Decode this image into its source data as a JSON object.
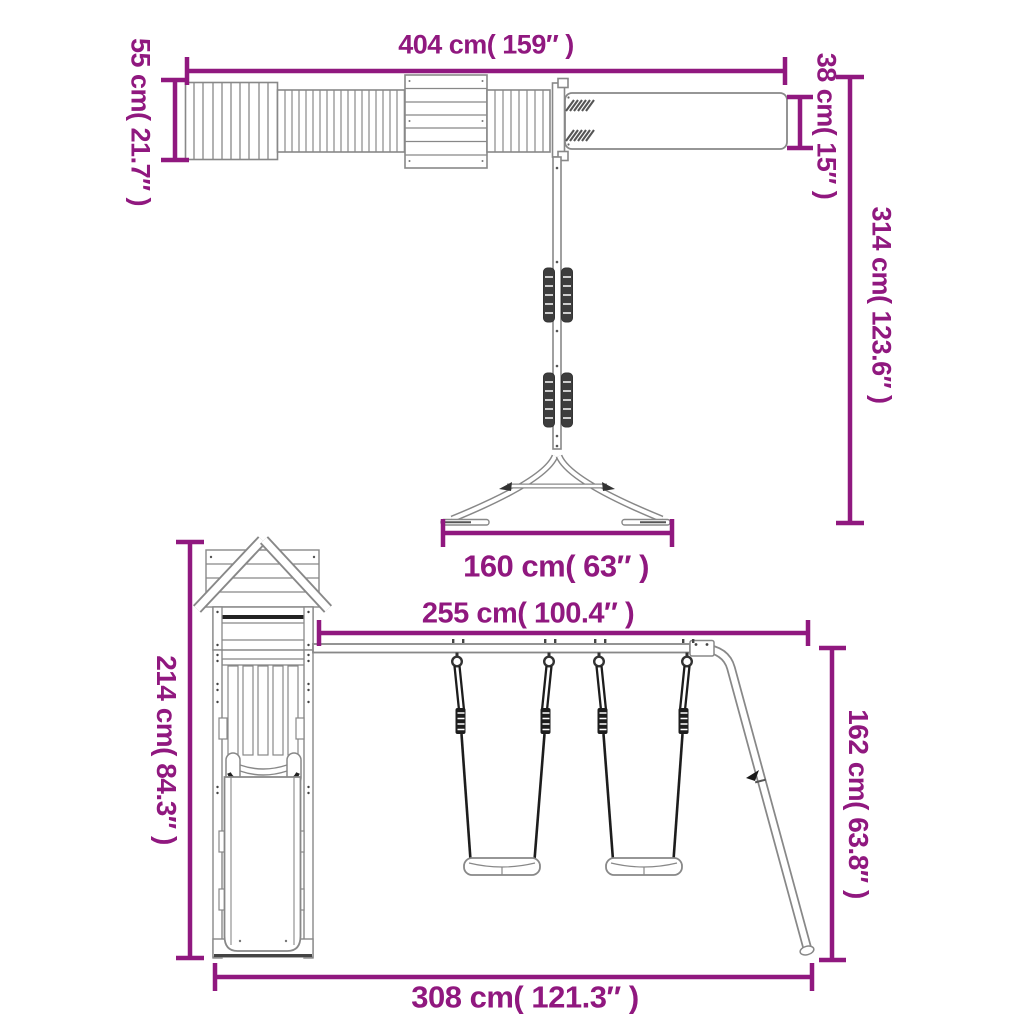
{
  "diagram": {
    "title": "Wooden playset with slide, swings and monkey bar — dimension diagram",
    "accent_color": "#90187F",
    "line_color": "#888888",
    "monkey_bar_view": {
      "total_width": "404 cm( 159″ )",
      "platform_depth": "55 cm( 21.7″ )",
      "beam_width": "38 cm( 15″ )",
      "height": "314 cm( 123.6″ )",
      "stand_base_width": "160 cm( 63″ )"
    },
    "playhouse_view": {
      "tower_height": "214 cm( 84.3″ )",
      "swing_beam_length": "255 cm( 100.4″ )",
      "swing_frame_height": "162 cm( 63.8″ )",
      "total_width": "308 cm( 121.3″ )"
    }
  }
}
